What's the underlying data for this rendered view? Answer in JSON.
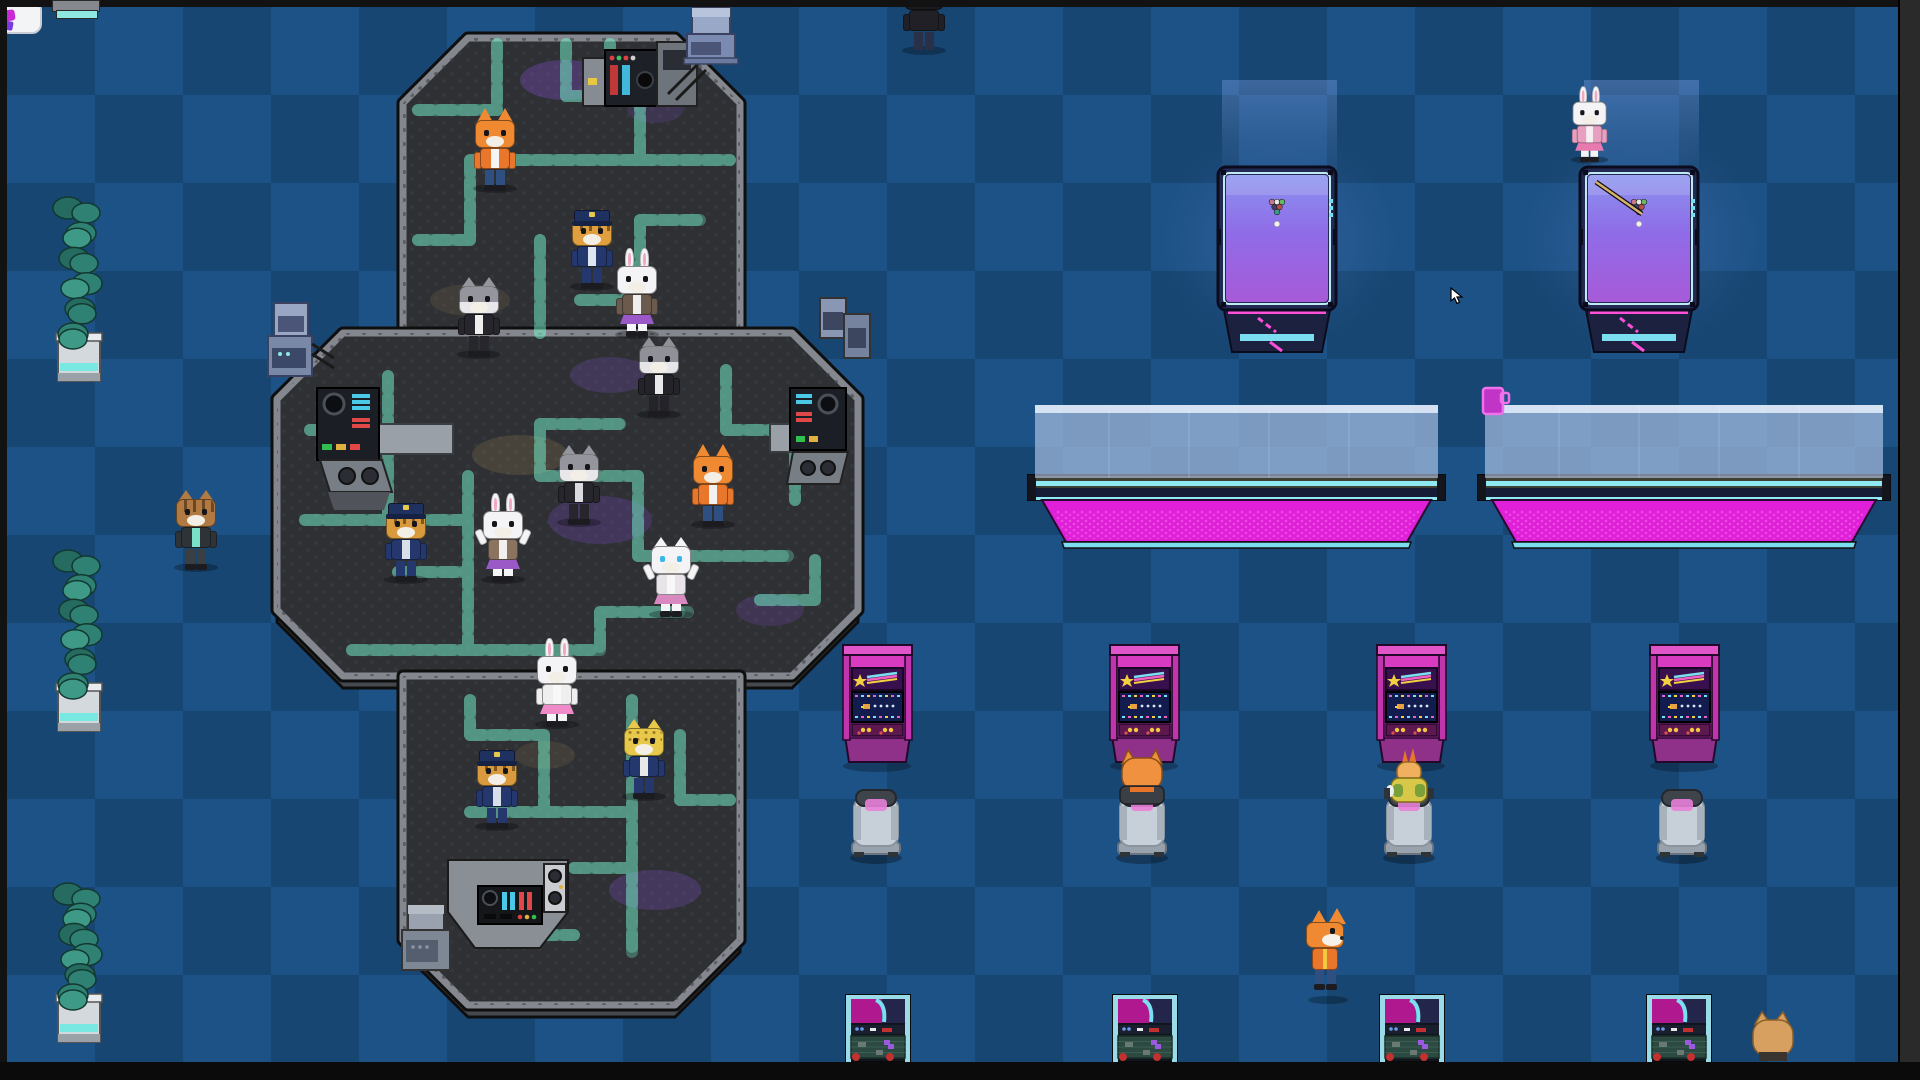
{
  "scene": {
    "width": 1920,
    "height": 1080
  },
  "floor": {
    "light": "#1d5286",
    "dark": "#174673",
    "tile": 88
  },
  "frame": {
    "top_h": 7,
    "left_w": 7,
    "right_x": 1898,
    "bottom_y": 1062,
    "bar_color": "#121212",
    "right_color": "#2a2a2a",
    "bottom_color": "#0b0b0b"
  },
  "fragment": {
    "tab_color": "#85898e",
    "teal_color": "#8fe8df"
  },
  "platform": {
    "surface": "#2e3034",
    "rim": "#84888e",
    "outline": "#0e0e0e",
    "skirt": "#45494f",
    "hex_dot": "#383c42",
    "circuit": "#8bf2d4",
    "circuit_glow": "rgba(120,245,205,0.30)"
  },
  "glow_patches": [
    [
      565,
      80,
      45,
      20,
      "#8a50d8",
      0.32
    ],
    [
      655,
      110,
      28,
      13,
      "#8a50d8",
      0.18
    ],
    [
      470,
      300,
      40,
      16,
      "#b0905a",
      0.15
    ],
    [
      610,
      375,
      40,
      18,
      "#8a50d8",
      0.22
    ],
    [
      520,
      455,
      48,
      20,
      "#b0905a",
      0.2
    ],
    [
      600,
      520,
      52,
      24,
      "#7a48c8",
      0.26
    ],
    [
      770,
      610,
      34,
      16,
      "#8a50d8",
      0.2
    ],
    [
      655,
      890,
      46,
      20,
      "#8a50d8",
      0.25
    ],
    [
      545,
      755,
      30,
      14,
      "#b0905a",
      0.15
    ]
  ],
  "plants": {
    "x": 54,
    "w": 49,
    "items": [
      {
        "y": 200,
        "h": 185
      },
      {
        "y": 553,
        "h": 182
      },
      {
        "y": 886,
        "h": 160
      }
    ],
    "leaf_dark": "#256b60",
    "leaf_mid": "#2f8273",
    "leaf_light": "#3e9a86",
    "pot": "#d4d9de",
    "pot_lip": "#e8ecef",
    "pot_band": "#7ae8e2",
    "pot_shade": "#9aa2a8"
  },
  "pool_tables": {
    "y": 167,
    "w": 118,
    "h": 143,
    "xs": [
      1218,
      1580
    ],
    "frame": "#232a52",
    "frame_line": "#0a0c1e",
    "cushion": "#bfeaf5",
    "felt_top": "#8b93ee",
    "felt_mid": "#8f6ce8",
    "felt_bot": "#a75ad8",
    "base": "#1c2140",
    "neon_pink": "#ff4fd8",
    "neon_cyan": "#7adef0",
    "balls": [
      [
        "#c8788a",
        -5,
        202
      ],
      [
        "#e8e8e8",
        0,
        202
      ],
      [
        "#68b868",
        5,
        202
      ],
      [
        "#404068",
        -2.5,
        207
      ],
      [
        "#c04848",
        2.5,
        207
      ],
      [
        "#3a9a8a",
        0,
        212
      ]
    ],
    "cue_ball": "#f2f2f2",
    "cue_stick_on": 1,
    "cue_stick_color": "#d9b36a"
  },
  "long_tables": {
    "glass_y": 405,
    "glass_h": 73,
    "frame_y": 475,
    "frame_h": 25,
    "base_y": 500,
    "base_h": 42,
    "items": [
      {
        "x": 1028,
        "w": 417
      },
      {
        "x": 1478,
        "w": 412
      }
    ],
    "glass": "rgba(188,205,238,0.62)",
    "glass_hi": "rgba(235,242,255,0.8)",
    "frame": "#3f4034",
    "cap": "#14161c",
    "cyan": "#8fe9f2",
    "navy": "#171c36",
    "base": "#e020d8",
    "base_dot": "#f25ae8",
    "foot": "#7adef0"
  },
  "cup": {
    "x": 1483,
    "y": 388,
    "body": "#c034c8",
    "outline": "#ef72ea"
  },
  "arcades": {
    "y": 645,
    "w": 69,
    "xs": [
      843,
      1110,
      1377,
      1650
    ],
    "top": "#e055c8",
    "body": "#d83bbf",
    "post": "#c035ab",
    "marquee": "#38104e",
    "star": "#f2d040",
    "screen": "#121c4e",
    "ship": "#e8a040",
    "panel": "#5e1850",
    "button": "#f2c840",
    "button2": "#e05050",
    "base": "#8f3189",
    "outline": "#24082a"
  },
  "chairs": {
    "y": 790,
    "w": 48,
    "xs": [
      852,
      1118,
      1385,
      1658
    ],
    "seat": "#c7d0d8",
    "seat_shade": "#a7b2bc",
    "back": "#3f444b",
    "cushion": "#e87fd8",
    "base": "#97a2ad",
    "foot": "#2e3338"
  },
  "sitters": [
    {
      "type": "cat-rear",
      "cx": 1142,
      "fur": "#f0913f",
      "ear_in": "#c86820",
      "jacket": "#3a3f46",
      "collar": "#e8742a"
    },
    {
      "type": "duck-rear",
      "cx": 1409,
      "crest": "#e87828",
      "head": "#f0b060",
      "body": "#d8c84a",
      "patch": "#7aa03a",
      "wing": "#eceff2",
      "arm": "#2e3338"
    }
  ],
  "bottom_arcades": {
    "y": 995,
    "w": 64,
    "h": 67,
    "xs": [
      846,
      1113,
      1380,
      1647
    ],
    "rail": "#9adbe8",
    "dark": "#10141c",
    "screen_l": "#b01890",
    "screen_r": "#23264a",
    "swoosh": "#7ae0f0",
    "row": "#1a1f30",
    "panel": "#2c4a42",
    "panel_line": "#3a5e52",
    "block": "#6a7a72",
    "piece": "#9a5ae0",
    "red": "#c23030"
  },
  "consoles": {
    "top_right": {
      "x": 583,
      "y": 42,
      "locker": "#878c94",
      "panel": "#1d2127",
      "led1": "#e04040",
      "led2": "#40c060",
      "bar_red": "#c03838",
      "bar_cyan": "#40b8d8",
      "unit": "#6e747c",
      "tag": "#e8c840"
    },
    "mid_left": {
      "panel": "#1b1e24",
      "deck": "#787e86",
      "desk": "#9aa0a8",
      "knob": "#0c0e12",
      "cyan": "#49c8e8",
      "red": "#e04848",
      "green": "#30c050",
      "yellow": "#e0b040"
    },
    "mid_right": {
      "panel": "#1b1e24",
      "deck": "#787e86",
      "desk": "#9aa0a8"
    },
    "bottom": {
      "base": "#8a8f96",
      "panel": "#14161a",
      "side": "#c9ccd1"
    }
  },
  "small_machines": {
    "left": {
      "x": 268,
      "y": 303,
      "c1": "#9aa7c4",
      "c2": "#7a88a8",
      "front": "#4a5578"
    },
    "right": {
      "x": 818,
      "y": 298,
      "c1": "#8a97b4",
      "c2": "#76839e",
      "front": "#3c465e"
    },
    "top_blue": {
      "x": 687,
      "y": 8,
      "c1": "#9aa8c8",
      "c2": "#7a8ab0",
      "front": "#4a5578"
    },
    "bottom_gray": {
      "x": 402,
      "y": 905,
      "c1": "#99a2ae",
      "c2": "#7e8894",
      "front": "#555e6e"
    }
  },
  "spotlights": {
    "xs": [
      1222,
      1584
    ],
    "y": 80,
    "w": 115,
    "h": 95
  },
  "characters": [
    {
      "name": "fox-orange-jacket",
      "x": 472,
      "y": 104,
      "ears": "fox",
      "fur": "#ef8a32",
      "outfit": "#e8772c",
      "shirt": "#f5f5f5",
      "pants": "#2e4f80"
    },
    {
      "name": "tiger-officer-1",
      "x": 569,
      "y": 202,
      "ears": "cat",
      "fur": "#e0a040",
      "stripes": true,
      "outfit": "#24386e",
      "shirt": "#dfe5ee",
      "pants": "#24386e",
      "hat": "#1e3160"
    },
    {
      "name": "rabbit-purple-skirt",
      "x": 614,
      "y": 250,
      "ears": "rabbit",
      "fur": "#f4f4f6",
      "outfit": "#6b5a4e",
      "shirt": "#efefef",
      "pants": "#f4f4f6",
      "skirt": "#9b59c8"
    },
    {
      "name": "husky-suit-1",
      "x": 456,
      "y": 270,
      "ears": "cat",
      "fur": "#95959d",
      "fur2": "#e8e8ea",
      "outfit": "#26262c",
      "shirt": "#efefef",
      "pants": "#26262c"
    },
    {
      "name": "husky-suit-2",
      "x": 636,
      "y": 330,
      "ears": "cat",
      "fur": "#8f9098",
      "fur2": "#e6e6e8",
      "outfit": "#232329",
      "shirt": "#e9e9e9",
      "pants": "#232329"
    },
    {
      "name": "husky-suit-3",
      "x": 556,
      "y": 438,
      "ears": "cat",
      "fur": "#95959d",
      "fur2": "#e8e8ea",
      "outfit": "#26262c",
      "shirt": "#dadae0",
      "pants": "#26262c"
    },
    {
      "name": "fox-vest",
      "x": 690,
      "y": 440,
      "ears": "fox",
      "fur": "#ef8a32",
      "outfit": "#e8772c",
      "shirt": "#f2f2f2",
      "pants": "#2e4f80"
    },
    {
      "name": "tiger-officer-2",
      "x": 383,
      "y": 495,
      "ears": "cat",
      "fur": "#d89a3c",
      "stripes": true,
      "outfit": "#24386e",
      "shirt": "#d8dfe8",
      "pants": "#24386e",
      "hat": "#1e3160"
    },
    {
      "name": "rabbit-arms-up",
      "x": 480,
      "y": 495,
      "ears": "rabbit",
      "fur": "#f4f4f6",
      "outfit": "#8a7460",
      "shirt": "#f0f0f0",
      "pants": "#f4f4f6",
      "skirt": "#9b59c8",
      "pose": "up"
    },
    {
      "name": "cat-white-pink",
      "x": 648,
      "y": 530,
      "ears": "cat",
      "fur": "#f4f4f6",
      "outfit": "#e8e4ea",
      "shirt": "#f8f8f8",
      "pants": "#f4f4f6",
      "skirt": "#d88ac0",
      "eyes": "#3ab6e8",
      "pose": "up"
    },
    {
      "name": "rabbit-pink-skirt",
      "x": 534,
      "y": 640,
      "ears": "rabbit",
      "fur": "#f4f4f6",
      "outfit": "#efefef",
      "shirt": "#f8f8f8",
      "pants": "#f4f4f6",
      "skirt": "#f08ac8"
    },
    {
      "name": "cheetah-suit",
      "x": 621,
      "y": 712,
      "ears": "cat",
      "fur": "#e8c84a",
      "spots": true,
      "outfit": "#24386e",
      "shirt": "#e8e8e8",
      "pants": "#24386e"
    },
    {
      "name": "tiger-officer-3",
      "x": 474,
      "y": 742,
      "ears": "cat",
      "fur": "#d89a3c",
      "stripes": true,
      "outfit": "#24386e",
      "shirt": "#d8dfe8",
      "pants": "#24386e",
      "hat": "#1e3160"
    },
    {
      "name": "tabby-cat-left",
      "x": 173,
      "y": 483,
      "ears": "cat",
      "fur": "#b07a42",
      "stripes": true,
      "outfit": "#2e3338",
      "shirt": "#7ae0c8",
      "pants": "#3a3f44"
    },
    {
      "name": "rabbit-pool-table",
      "x": 1570,
      "y": 88,
      "ears": "rabbit",
      "fur": "#f4f4f6",
      "outfit": "#e8a0c0",
      "shirt": "#f6eef2",
      "pants": "#f4f4f6",
      "skirt": "#e87ab0",
      "scale": 0.85
    },
    {
      "name": "figure-top-cut",
      "x": 901,
      "y": -34,
      "ears": "none",
      "faceless": true,
      "fur": "#1b1b1f",
      "outfit": "#202026",
      "pants": "#2a3048"
    }
  ],
  "fox_bubble": {
    "fox_x": 1306,
    "fox_y": 914,
    "bubble_x": 1303,
    "bubble_y": 881,
    "fur": "#ef8a32",
    "vest": "#e8772c",
    "trim": "#f2c840",
    "pants": "#2e4f80",
    "bubble_bg": "#f2f4f6",
    "bubble_edge": "#c8ccd4",
    "icon1": "#c82ad8",
    "icon2": "#7a3ae0"
  },
  "tan_cat": {
    "x": 1753,
    "y": 1014,
    "fur": "#d8a060",
    "ear_in": "#b07838",
    "collar": "#3a3530"
  },
  "cursor": {
    "x": 1450,
    "y": 287,
    "fill": "#ffffff",
    "edge": "#000000"
  }
}
